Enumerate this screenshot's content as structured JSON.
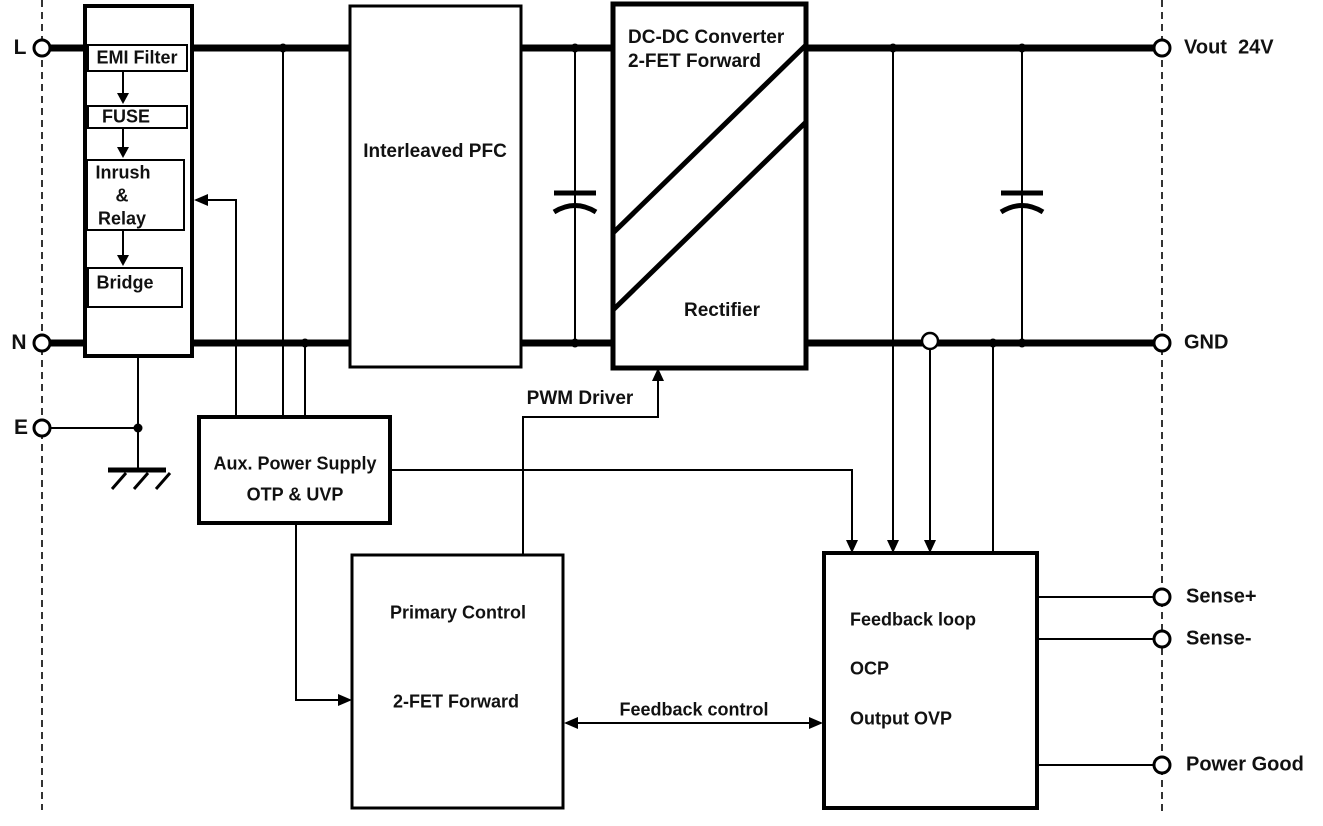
{
  "diagram": {
    "terminals": {
      "l": "L",
      "n": "N",
      "e": "E",
      "vout": "Vout  24V",
      "gnd": "GND",
      "sense_plus": "Sense+",
      "sense_minus": "Sense-",
      "power_good": "Power Good"
    },
    "blocks": {
      "input_filter": {
        "emi": "EMI Filter",
        "fuse": "FUSE",
        "inrush_line1": "Inrush",
        "inrush_line2": "&",
        "inrush_line3": "Relay",
        "bridge": "Bridge"
      },
      "pfc": {
        "title": "Interleaved PFC"
      },
      "dcdc": {
        "title_line1": "DC-DC Converter",
        "title_line2": "2-FET Forward",
        "rectifier": "Rectifier"
      },
      "aux": {
        "line1": "Aux. Power Supply",
        "line2": "OTP & UVP"
      },
      "primary": {
        "line1": "Primary Control",
        "line2": "2-FET Forward"
      },
      "feedback": {
        "line1": "Feedback loop",
        "line2": "OCP",
        "line3": "Output OVP"
      }
    },
    "wire_labels": {
      "pwm": "PWM Driver",
      "feedback_control": "Feedback control"
    },
    "colors": {
      "line": "#000000",
      "text": "#111111",
      "background": "#ffffff",
      "dashed_rail": "#333333"
    }
  }
}
